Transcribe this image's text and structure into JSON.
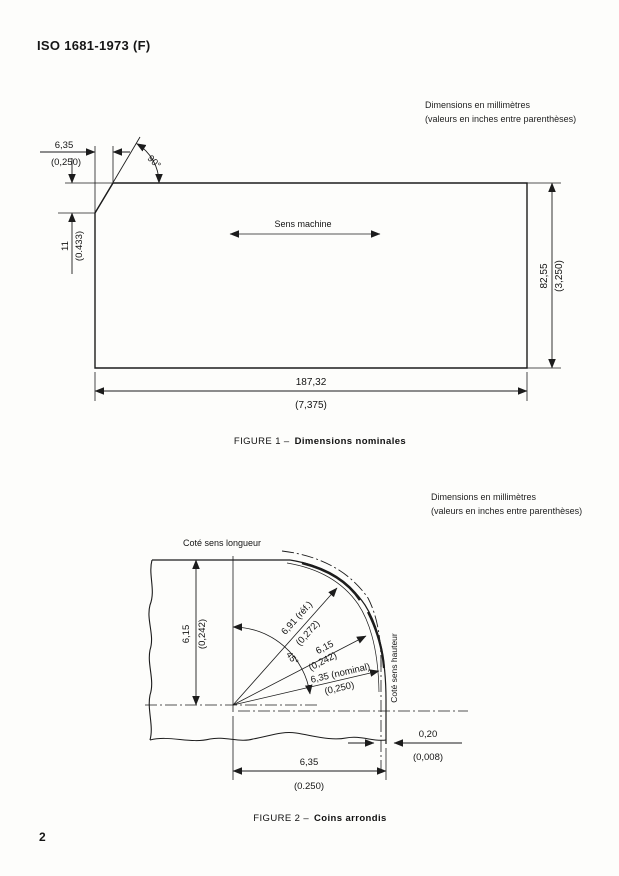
{
  "page": {
    "header": "ISO 1681-1973 (F)",
    "page_number": "2"
  },
  "note1": {
    "line1": "Dimensions en millimètres",
    "line2": "(valeurs en inches entre parenthèses)"
  },
  "note2": {
    "line1": "Dimensions en millimètres",
    "line2": "(valeurs en inches entre parenthèses)"
  },
  "figure1": {
    "caption_label": "FIGURE 1 –",
    "caption_title": "Dimensions nominales",
    "machine_direction": "Sens machine",
    "angle": "90°",
    "dim_corner_w_mm": "6,35",
    "dim_corner_w_in": "(0,250)",
    "dim_corner_h_mm": "11",
    "dim_corner_h_in": "(0.433)",
    "dim_height_mm": "82,55",
    "dim_height_in": "(3,250)",
    "dim_width_mm": "187,32",
    "dim_width_in": "(7,375)"
  },
  "figure2": {
    "caption_label": "FIGURE 2 –",
    "caption_title": "Coins arrondis",
    "label_length_side": "Coté sens longueur",
    "label_height_side": "Coté sens hauteur",
    "angle": "45°",
    "dim_left_mm": "6,15",
    "dim_left_in": "(0,242)",
    "dim_r1_mm": "6,91 (réf.)",
    "dim_r1_in": "(0,272)",
    "dim_r2_mm": "6,15",
    "dim_r2_in": "(0,242)",
    "dim_r3_mm": "6,35 (nominal)",
    "dim_r3_in": "(0,250)",
    "dim_gap_mm": "0,20",
    "dim_gap_in": "(0,008)",
    "dim_bottom_mm": "6,35",
    "dim_bottom_in": "(0.250)"
  }
}
